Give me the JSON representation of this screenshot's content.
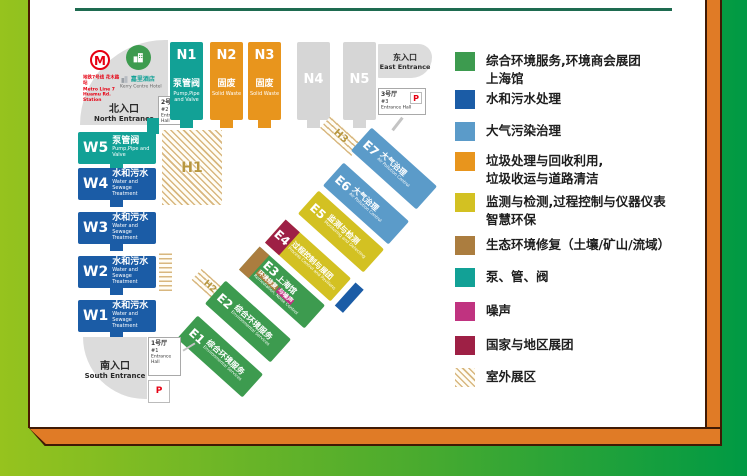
{
  "legend": {
    "items": [
      {
        "color": "#3d9b4f",
        "label": "综合环境服务,环境商会展团",
        "label2": "上海馆"
      },
      {
        "color": "#1b5ca6",
        "label": "水和污水处理",
        "label2": ""
      },
      {
        "color": "#5b9bc9",
        "label": "大气污染治理",
        "label2": ""
      },
      {
        "color": "#e8951d",
        "label": "垃圾处理与回收利用,",
        "label2": "垃圾收运与道路清洁"
      },
      {
        "color": "#d3c122",
        "label": "监测与检测,过程控制与仪器仪表",
        "label2": "智慧环保"
      },
      {
        "color": "#ab7d3f",
        "label": "生态环境修复（土壤/矿山/流域）",
        "label2": ""
      },
      {
        "color": "#12a196",
        "label": "泵、管、阀",
        "label2": ""
      },
      {
        "color": "#c03380",
        "label": "噪声",
        "label2": ""
      },
      {
        "color": "#9e2045",
        "label": "国家与地区展团",
        "label2": ""
      },
      {
        "color": "hatched",
        "label": "室外展区",
        "label2": ""
      }
    ]
  },
  "map": {
    "halls_n": [
      {
        "id": "N1",
        "cn": "泵管阀",
        "en": "Pump,Pipe and Valve",
        "color": "#12a196"
      },
      {
        "id": "N2",
        "cn": "固废",
        "en": "Solid Waste",
        "color": "#e8951d"
      },
      {
        "id": "N3",
        "cn": "固废",
        "en": "Solid Waste",
        "color": "#e8951d"
      },
      {
        "id": "N4",
        "cn": "",
        "en": "",
        "color": "#d6d6d6"
      },
      {
        "id": "N5",
        "cn": "",
        "en": "",
        "color": "#d6d6d6"
      }
    ],
    "halls_w": [
      {
        "id": "W5",
        "cn": "泵管阀",
        "en": "Pump,Pipe and Valve",
        "color": "#12a196"
      },
      {
        "id": "W4",
        "cn": "水和污水",
        "en": "Water and Sewage Treatment",
        "color": "#1b5ca6"
      },
      {
        "id": "W3",
        "cn": "水和污水",
        "en": "Water and Sewage Treatment",
        "color": "#1b5ca6"
      },
      {
        "id": "W2",
        "cn": "水和污水",
        "en": "Water and Sewage Treatment",
        "color": "#1b5ca6"
      },
      {
        "id": "W1",
        "cn": "水和污水",
        "en": "Water and Sewage Treatment",
        "color": "#1b5ca6"
      }
    ],
    "halls_e": [
      {
        "id": "E1",
        "cn": "综合环境服务",
        "en": "Environmental Services",
        "color": "#3d9b4f"
      },
      {
        "id": "E2",
        "cn": "综合环境服务",
        "en": "Environmental Services",
        "color": "#3d9b4f"
      },
      {
        "id": "E3",
        "cn": "上海馆",
        "chip1": "环境修复",
        "chip2": "与噪声",
        "en": "Remediation, Noise Control",
        "en2": "Shanghai Pavilion",
        "color": "#3d9b4f"
      },
      {
        "id": "E4",
        "cn": "过程控制与展团",
        "en": "Process Control and Pavilions",
        "color": "#d3c122"
      },
      {
        "id": "E5",
        "cn": "监测与检测",
        "en": "Monitoring and Detecting",
        "color": "#d3c122"
      },
      {
        "id": "E6",
        "cn": "大气治理",
        "en": "Air Pollution Control",
        "color": "#5b9bc9"
      },
      {
        "id": "E7",
        "cn": "大气治理",
        "en": "Air Pollution Control",
        "color": "#5b9bc9"
      }
    ],
    "outdoor": {
      "h1": "H1",
      "h2": "H2",
      "h3": "H3"
    },
    "entrances": {
      "north": {
        "cn": "北入口",
        "en": "North Entrance",
        "metro_cn": "地铁7号线 花木路站",
        "metro_en": "Metro Line 7 Huamu Rd. Station",
        "metro_letter": "M",
        "hotel_cn": "嘉里酒店",
        "hotel_en": "Kerry Centre Hotel",
        "hall_cn": "2号厅",
        "hall_no": "#2",
        "hall_en": "Entrance Hall"
      },
      "east": {
        "cn": "东入口",
        "en": "East Entrance",
        "hall_cn": "3号厅",
        "hall_no": "#3",
        "hall_en": "Entrance Hall",
        "parking": "P"
      },
      "south": {
        "cn": "南入口",
        "en": "South Entrance",
        "hall_cn": "1号厅",
        "hall_no": "#1",
        "hall_en": "Entrance Hall",
        "parking": "P"
      }
    }
  }
}
